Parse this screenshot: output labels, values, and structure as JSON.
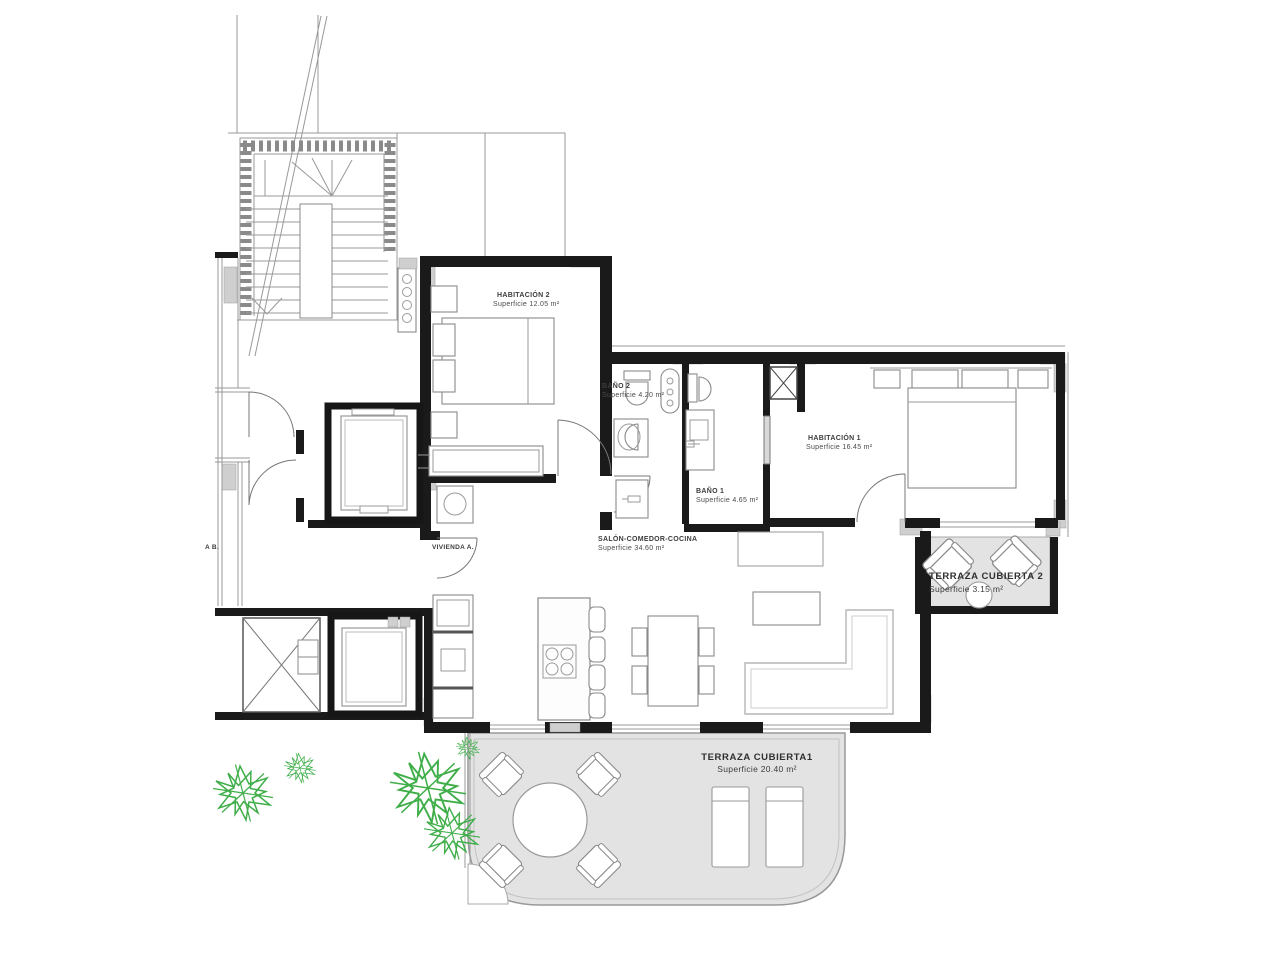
{
  "plan": {
    "rooms": {
      "habitacion2": {
        "name": "HABITACIÓN 2",
        "area": "Superficie 12.05 m²"
      },
      "bano2": {
        "name": "BAÑO 2",
        "area": "Superficie 4.20 m²"
      },
      "habitacion1": {
        "name": "HABITACIÓN 1",
        "area": "Superficie 16.45 m²"
      },
      "bano1": {
        "name": "BAÑO 1",
        "area": "Superficie 4.65 m²"
      },
      "salon": {
        "name": "SALÓN-COMEDOR-COCINA",
        "area": "Superficie 34.60 m²"
      },
      "terraza2": {
        "name": "TERRAZA CUBIERTA 2",
        "area": "Superficie 3.15 m²"
      },
      "terraza1": {
        "name": "TERRAZA CUBIERTA1",
        "area": "Superficie 20.40 m²"
      }
    },
    "units": {
      "vivienda_a": "VIVIENDA A.",
      "vivienda_b": "A B."
    },
    "colors": {
      "wall": "#1a1a1a",
      "line": "#999999",
      "poche": "#cfcfcf",
      "terrace_floor": "#e3e3e3",
      "plant": "#3fae49",
      "label": "#4a4a4a"
    }
  }
}
